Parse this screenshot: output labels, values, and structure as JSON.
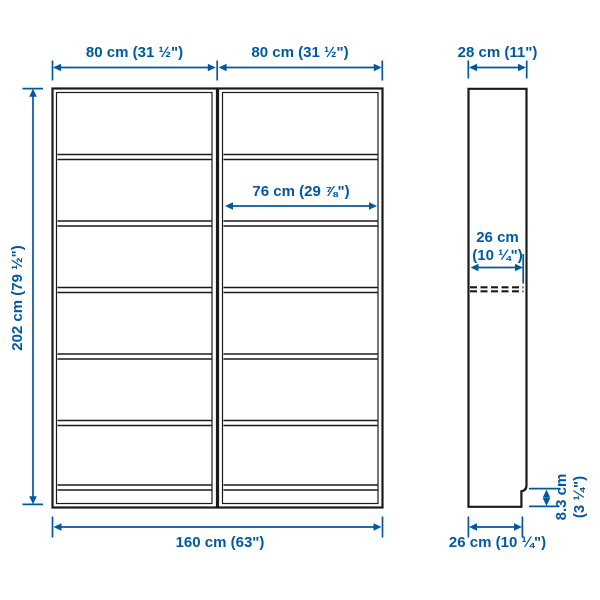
{
  "diagram": {
    "subject": "two-section bookcase with side view",
    "accent_color": "#0058A3",
    "outline_color": "#1a1a1a",
    "background_color": "#ffffff"
  },
  "dimensions": {
    "left_unit_width": "80 cm (31 ½\")",
    "right_unit_width": "80 cm (31 ½\")",
    "side_depth_top": "28 cm (11\")",
    "total_height": "202 cm (79 ½\")",
    "shelf_inner_width": "76 cm (29 ⅞\")",
    "shelf_inner_depth": [
      "26 cm",
      "(10 ¼\")"
    ],
    "total_width": "160 cm (63\")",
    "base_depth": "26 cm (10 ¼\")",
    "plinth_height": [
      "8.3 cm",
      "(3 ¼\")"
    ]
  }
}
